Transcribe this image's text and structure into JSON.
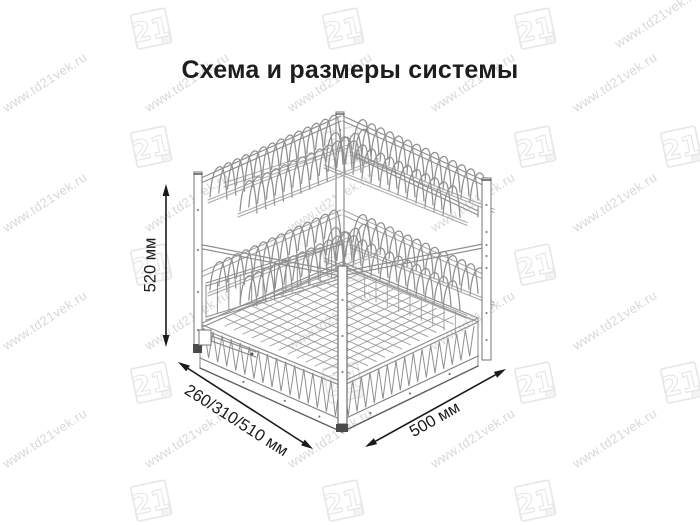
{
  "page": {
    "background": "#ffffff"
  },
  "title": {
    "text": "Схема и размеры системы",
    "color": "#1d1d1d"
  },
  "watermark": {
    "url_text": "www.td21vek.ru",
    "logo_text": "21",
    "text_color": "#d8d8d8",
    "logo_color": "#e6e6e6"
  },
  "dimensions": {
    "height": {
      "label": "520 мм"
    },
    "depth": {
      "label": "260/310/510 мм"
    },
    "width": {
      "label": "500 мм"
    }
  },
  "diagram": {
    "subject": "two-tier pull-out dish drying rack with bottom wire basket",
    "line_color": "#8f8f8f",
    "light_color": "#a6a6a6",
    "dark_color": "#4a4a4a",
    "arrow_color": "#1a1a1a"
  }
}
